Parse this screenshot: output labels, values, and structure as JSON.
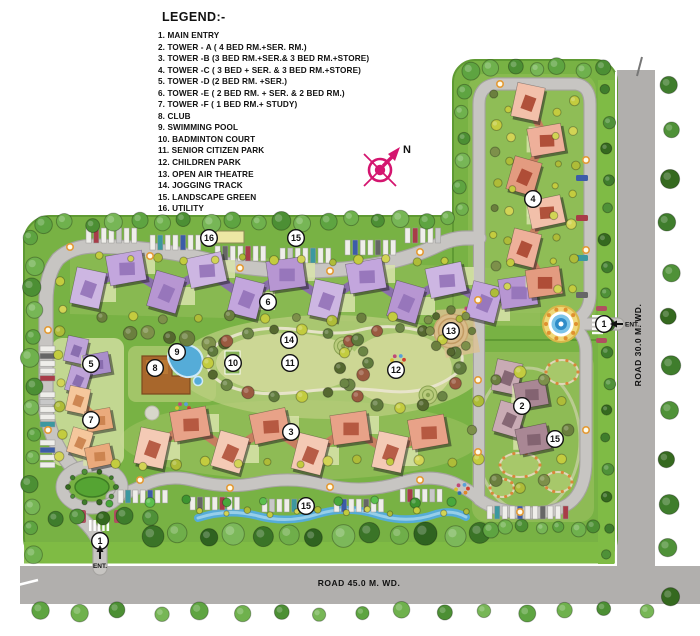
{
  "legend": {
    "title": "LEGEND:-",
    "items": [
      "1. MAIN ENTRY",
      "2. TOWER - A ( 4 BED RM.+SER. RM.)",
      "3. TOWER -B (3 BED RM.+SER.& 3 BED RM.+STORE)",
      "4. TOWER -C ( 3 BED + SER. & 3 BED RM.+STORE)",
      "5. TOWER -D (2 BED RM. +SER.)",
      "6. TOWER -E ( 2 BED RM. + SER. & 2 BED RM.)",
      "7. TOWER -F ( 1 BED RM.+ STUDY)",
      "8. CLUB",
      "9. SWIMMING POOL",
      "10. BADMINTON COURT",
      "11. SENIOR CITIZEN PARK",
      "12. CHILDREN PARK",
      "13. OPEN AIR THEATRE",
      "14. JOGGING TRACK",
      "15. LANDSCAPE GREEN",
      "16. UTILITY"
    ]
  },
  "compass": {
    "label": "N"
  },
  "roads": {
    "bottom_label": "ROAD 45.0 M. WD.",
    "right_label": "ROAD 30.0 M. WD."
  },
  "entries": [
    {
      "label": "ENT.",
      "x": 100,
      "y": 541,
      "dir": "up"
    },
    {
      "label": "ENT.",
      "x": 604,
      "y": 324,
      "dir": "left"
    }
  ],
  "markers": [
    {
      "n": "1",
      "x": 100,
      "y": 541
    },
    {
      "n": "1",
      "x": 604,
      "y": 324
    },
    {
      "n": "2",
      "x": 522,
      "y": 406
    },
    {
      "n": "3",
      "x": 291,
      "y": 432
    },
    {
      "n": "4",
      "x": 533,
      "y": 199
    },
    {
      "n": "5",
      "x": 91,
      "y": 364
    },
    {
      "n": "6",
      "x": 268,
      "y": 302
    },
    {
      "n": "7",
      "x": 91,
      "y": 420
    },
    {
      "n": "8",
      "x": 155,
      "y": 368
    },
    {
      "n": "9",
      "x": 177,
      "y": 352
    },
    {
      "n": "10",
      "x": 233,
      "y": 363
    },
    {
      "n": "11",
      "x": 290,
      "y": 363
    },
    {
      "n": "12",
      "x": 396,
      "y": 370
    },
    {
      "n": "13",
      "x": 451,
      "y": 331
    },
    {
      "n": "14",
      "x": 289,
      "y": 340
    },
    {
      "n": "15",
      "x": 296,
      "y": 238
    },
    {
      "n": "15",
      "x": 555,
      "y": 439
    },
    {
      "n": "15",
      "x": 306,
      "y": 506
    },
    {
      "n": "16",
      "x": 209,
      "y": 238
    }
  ],
  "colors": {
    "compass_magenta": "#d4156f",
    "main_road_gray": "#b1afad",
    "inner_road_gray": "#c7c5c2",
    "site_green": "#78b244",
    "hedge_green": "#7fbb45",
    "lawn_light": "#ccd795",
    "water_blue": "#55acd8",
    "tower_a_mauve": "#c9abb4",
    "tower_b_salmon": "#e8a288",
    "tower_c_salmon": "#eeb09a",
    "tower_d_purple": "#bea3d8",
    "tower_e_lavender": "#c3a6dd",
    "tower_f_peach": "#f5c79c",
    "club_brown": "#a8672c",
    "theatre_tan": "#d9bc8a",
    "utility_yellow": "#ece7a4",
    "marker_white": "#ffffff",
    "marker_stroke": "#111111"
  }
}
